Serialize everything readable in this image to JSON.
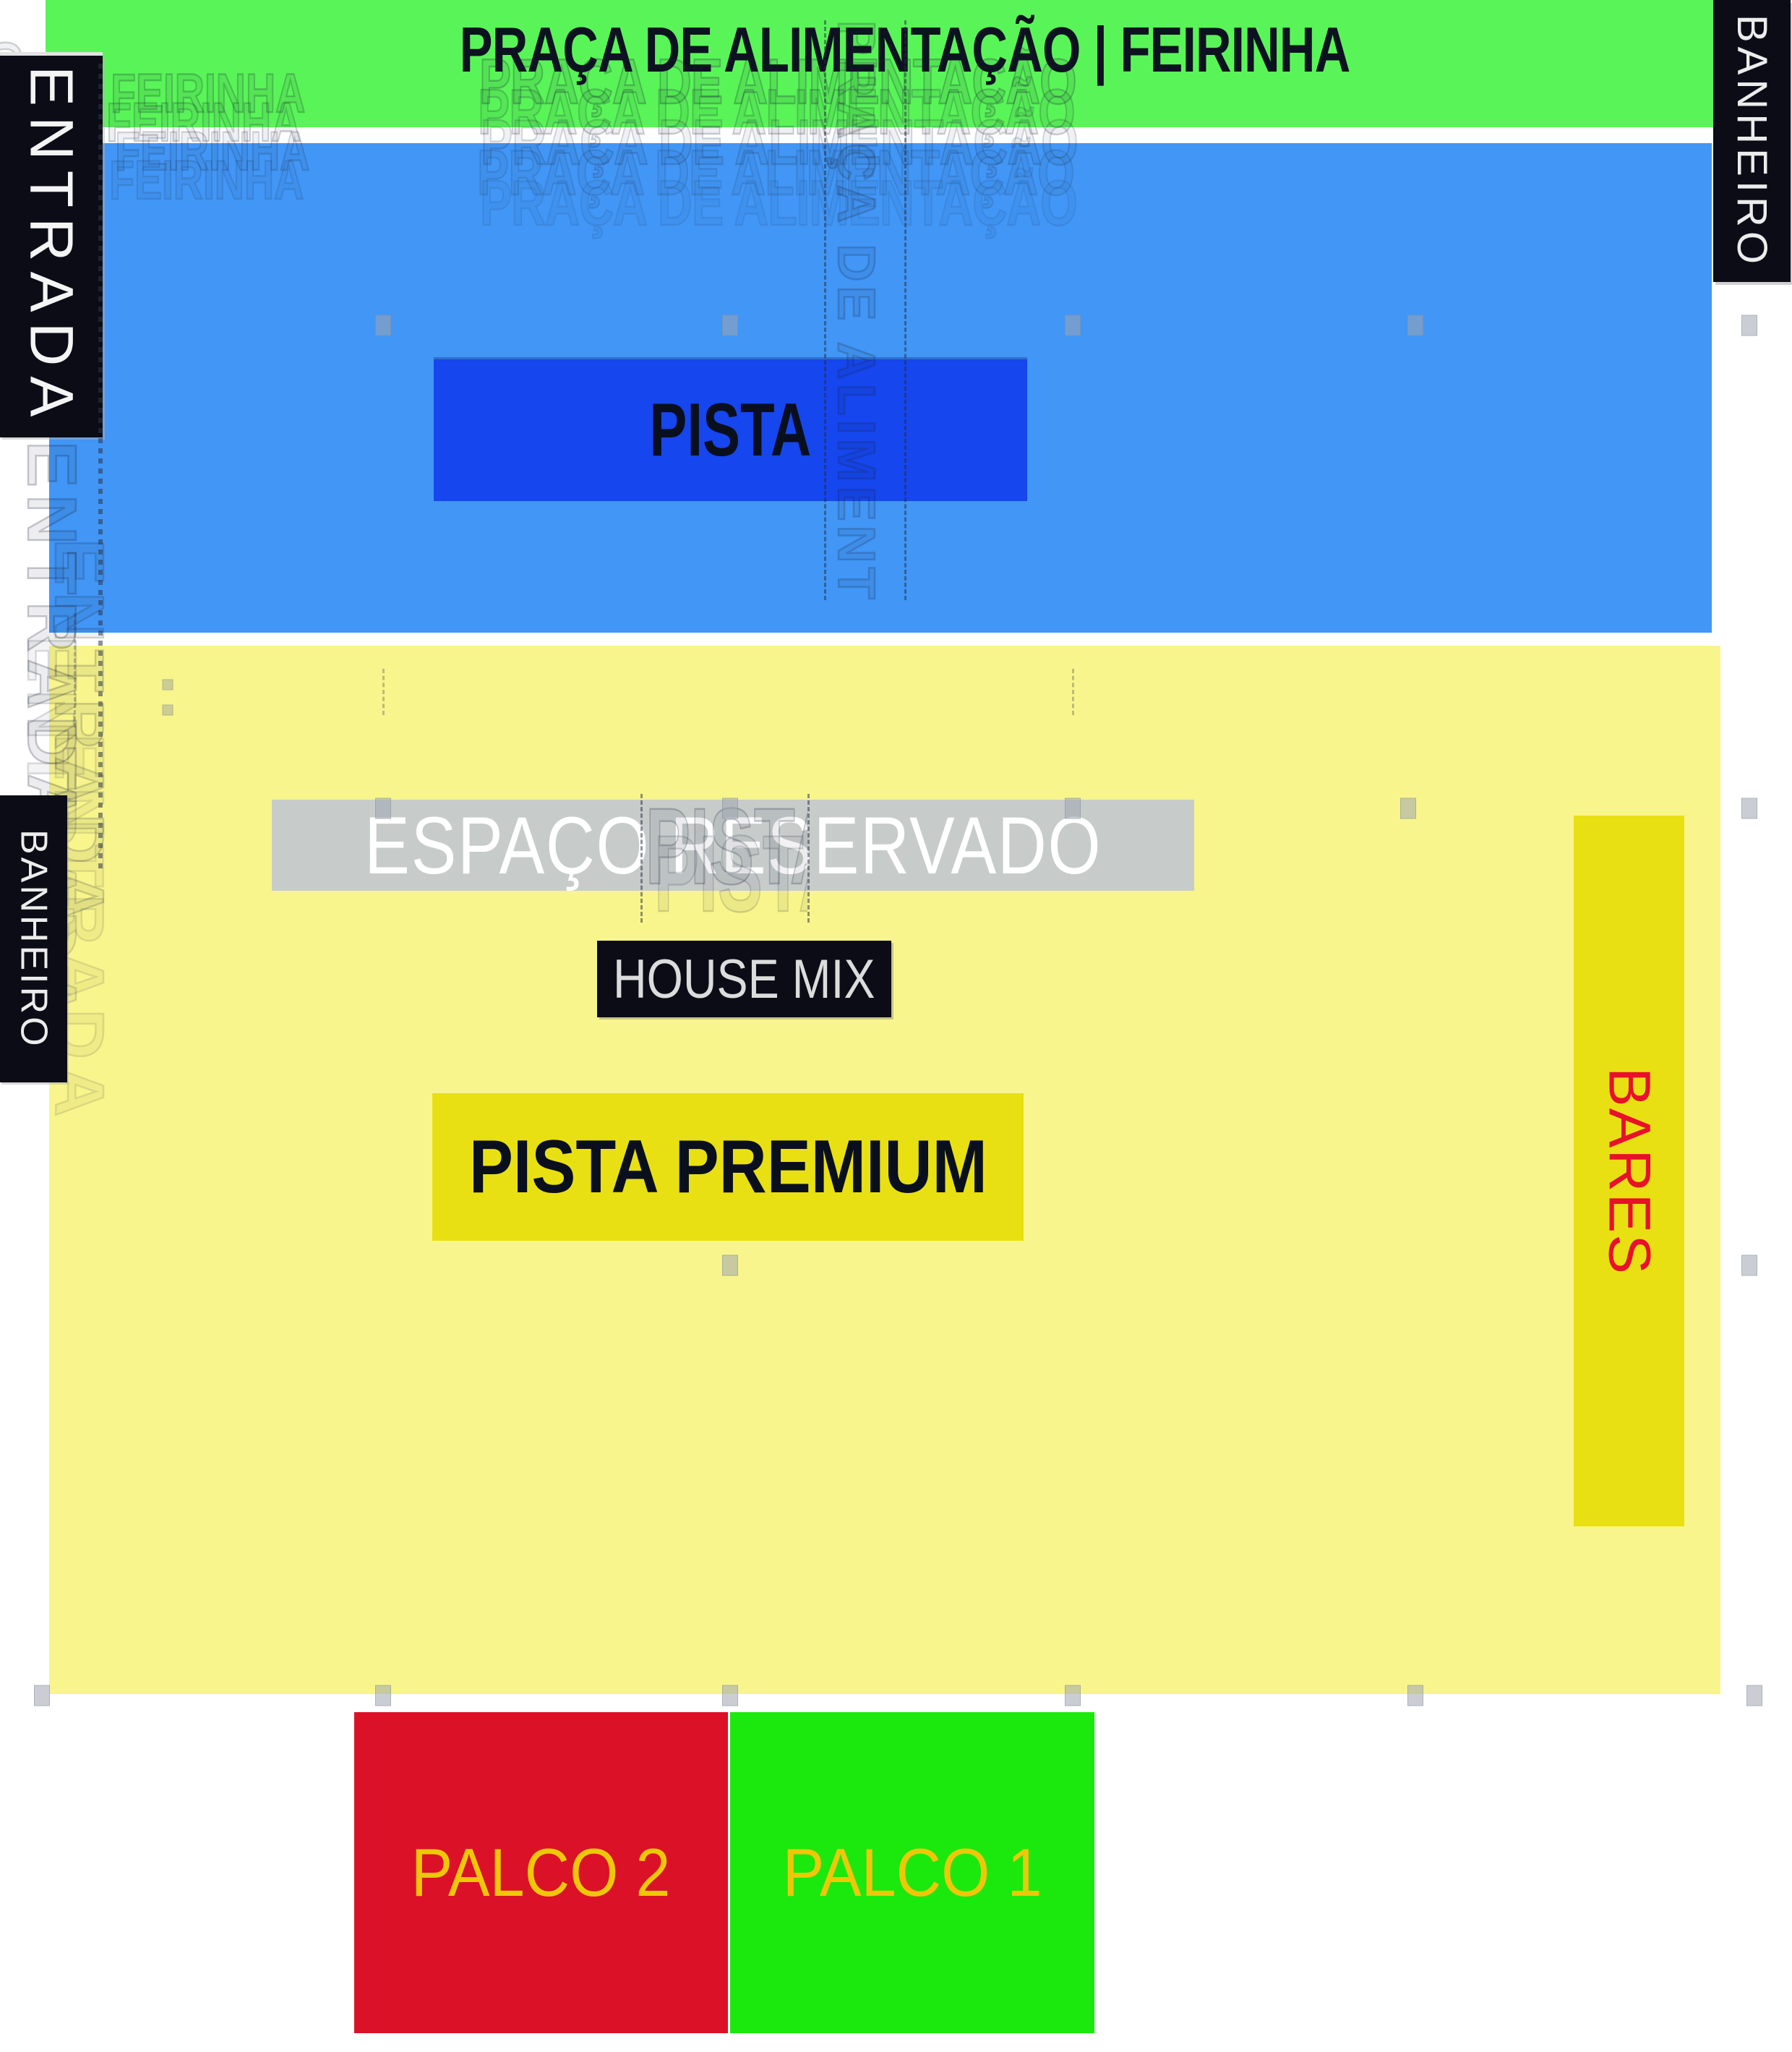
{
  "title": {
    "text": "PRAÇA DE ALIMENTAÇÃO | FEIRINHA"
  },
  "zones": {
    "entrada": {
      "label": "ENTRADA"
    },
    "banheiro_right": {
      "label": "BANHEIRO"
    },
    "banheiro_left": {
      "label": "BANHEIRO"
    },
    "pista": {
      "label": "PISTA"
    },
    "espaco_reservado": {
      "label": "ESPAÇO RESERVADO"
    },
    "house_mix": {
      "label": "HOUSE MIX"
    },
    "pista_premium": {
      "label": "PISTA PREMIUM"
    },
    "bares": {
      "label": "BARES"
    },
    "palco_2": {
      "label": "PALCO 2"
    },
    "palco_1": {
      "label": "PALCO 1"
    }
  },
  "ghosts": {
    "title_echo": {
      "text": "PRAÇA DE ALIMENTAÇÃO"
    },
    "corner_echo": {
      "text": "ÃO | FEIRINHA"
    },
    "entrada_echo": {
      "text": "ENTRADA"
    },
    "strip_echo": {
      "text": "PRAÇA DE ALIMENTAÇÃO | FEIRINHA"
    },
    "pista_echo": {
      "text": "PISTA"
    },
    "leftedge_echo": {
      "text": "ÇÃO | FEIRINHA"
    }
  },
  "colors": {
    "green_band": "#59F558",
    "blue_bg": "#4196F6",
    "pista_blue": "#1546EE",
    "pale_yellow": "#F8F58C",
    "strong_yellow": "#E8E012",
    "gray_box": "#C7CCCB",
    "dark_box": "#0B0C16",
    "red_palco": "#DB1127",
    "green_palco": "#1BE80D",
    "text_yellow": "#EFC709",
    "bares_red": "#E8102A"
  },
  "handles": [
    [
      530,
      450
    ],
    [
      1010,
      450
    ],
    [
      1484,
      450
    ],
    [
      1958,
      450
    ],
    [
      2420,
      450
    ],
    [
      530,
      1118
    ],
    [
      1010,
      1118
    ],
    [
      1484,
      1118
    ],
    [
      1948,
      1118
    ],
    [
      2420,
      1118
    ],
    [
      1010,
      1750
    ],
    [
      2420,
      1750
    ],
    [
      58,
      2345
    ],
    [
      530,
      2345
    ],
    [
      1010,
      2345
    ],
    [
      1484,
      2345
    ],
    [
      1958,
      2345
    ],
    [
      2427,
      2345
    ]
  ],
  "small_handles": [
    [
      232,
      947
    ],
    [
      232,
      982
    ]
  ]
}
